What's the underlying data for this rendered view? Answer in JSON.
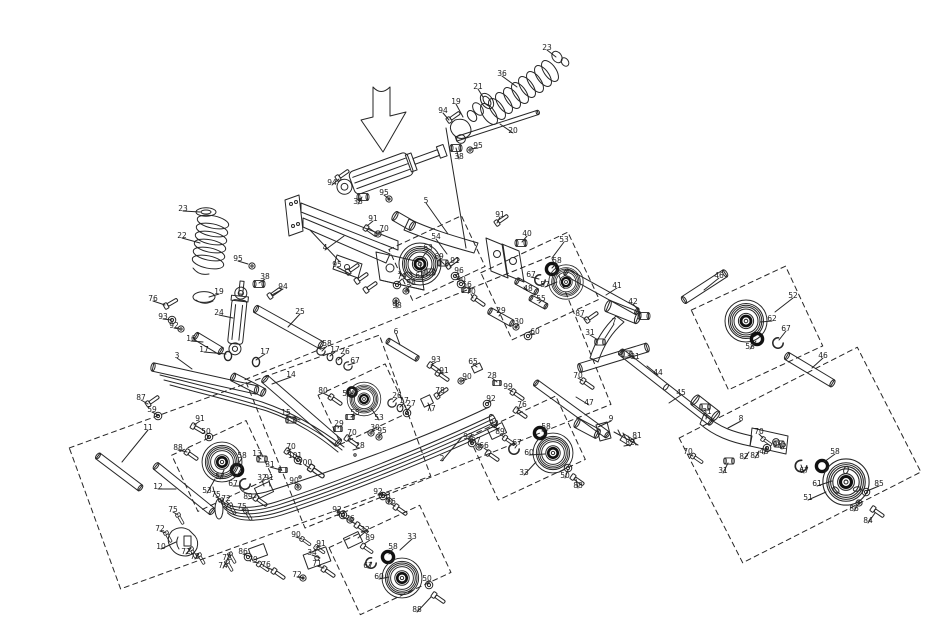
{
  "diagram": {
    "type": "exploded-parts-diagram",
    "subject": "snowmobile rear suspension skid frame",
    "background": "#ffffff",
    "line_color": "#262626",
    "highlight_arrow_color": "#e01c1c",
    "highlight_target": "rear shock absorber"
  },
  "callouts": [
    {
      "n": "23",
      "x": 547,
      "y": 48,
      "t": [
        556,
        57
      ]
    },
    {
      "n": "36",
      "x": 502,
      "y": 74,
      "t": [
        517,
        87
      ]
    },
    {
      "n": "21",
      "x": 478,
      "y": 87,
      "t": [
        483,
        97
      ]
    },
    {
      "n": "19",
      "x": 456,
      "y": 102,
      "t": [
        463,
        117
      ]
    },
    {
      "n": "94",
      "x": 443,
      "y": 111,
      "t": [
        449,
        120
      ]
    },
    {
      "n": "20",
      "x": 513,
      "y": 131,
      "t": [
        500,
        124
      ]
    },
    {
      "n": "95",
      "x": 478,
      "y": 146,
      "t": [
        470,
        149
      ]
    },
    {
      "n": "38",
      "x": 459,
      "y": 157,
      "t": [
        456,
        148
      ]
    },
    {
      "n": "94",
      "x": 332,
      "y": 183,
      "t": [
        339,
        179
      ]
    },
    {
      "n": "95",
      "x": 384,
      "y": 193,
      "t": [
        389,
        199
      ]
    },
    {
      "n": "38",
      "x": 358,
      "y": 202,
      "t": [
        362,
        197
      ]
    },
    {
      "n": "5",
      "x": 426,
      "y": 201,
      "t": [
        448,
        234
      ]
    },
    {
      "n": "91",
      "x": 373,
      "y": 219,
      "t": [
        367,
        226
      ]
    },
    {
      "n": "70",
      "x": 384,
      "y": 229,
      "t": [
        378,
        233
      ]
    },
    {
      "n": "23",
      "x": 183,
      "y": 209,
      "t": [
        200,
        212
      ]
    },
    {
      "n": "22",
      "x": 182,
      "y": 236,
      "t": [
        200,
        243
      ]
    },
    {
      "n": "19",
      "x": 219,
      "y": 292,
      "t": [
        209,
        297
      ]
    },
    {
      "n": "95",
      "x": 238,
      "y": 259,
      "t": [
        248,
        264
      ]
    },
    {
      "n": "38",
      "x": 265,
      "y": 277,
      "t": [
        259,
        283
      ]
    },
    {
      "n": "94",
      "x": 283,
      "y": 287,
      "t": [
        272,
        295
      ]
    },
    {
      "n": "24",
      "x": 219,
      "y": 313,
      "t": [
        233,
        318
      ]
    },
    {
      "n": "25",
      "x": 300,
      "y": 312,
      "t": [
        288,
        327
      ]
    },
    {
      "n": "76",
      "x": 153,
      "y": 299,
      "t": [
        165,
        305
      ]
    },
    {
      "n": "93",
      "x": 163,
      "y": 317,
      "t": [
        172,
        320
      ]
    },
    {
      "n": "92",
      "x": 174,
      "y": 326,
      "t": [
        180,
        329
      ]
    },
    {
      "n": "16",
      "x": 191,
      "y": 339,
      "t": [
        203,
        342
      ]
    },
    {
      "n": "17",
      "x": 204,
      "y": 350,
      "t": [
        226,
        354
      ]
    },
    {
      "n": "17",
      "x": 265,
      "y": 352,
      "t": [
        256,
        360
      ]
    },
    {
      "n": "4",
      "x": 325,
      "y": 248,
      "t": [
        344,
        236
      ]
    },
    {
      "n": "54",
      "x": 436,
      "y": 237,
      "t": [
        447,
        254
      ]
    },
    {
      "n": "63",
      "x": 428,
      "y": 248,
      "t": [
        422,
        258
      ]
    },
    {
      "n": "69",
      "x": 439,
      "y": 257,
      "t": [
        444,
        264
      ]
    },
    {
      "n": "64",
      "x": 420,
      "y": 276,
      "t": [
        430,
        272
      ]
    },
    {
      "n": "79",
      "x": 402,
      "y": 277,
      "t": [
        397,
        284
      ]
    },
    {
      "n": "98",
      "x": 411,
      "y": 283,
      "t": [
        406,
        290
      ]
    },
    {
      "n": "98",
      "x": 397,
      "y": 306,
      "t": [
        396,
        300
      ]
    },
    {
      "n": "95",
      "x": 337,
      "y": 265,
      "t": [
        350,
        274
      ]
    },
    {
      "n": "91",
      "x": 455,
      "y": 261,
      "t": [
        450,
        267
      ]
    },
    {
      "n": "96",
      "x": 459,
      "y": 271,
      "t": [
        455,
        276
      ]
    },
    {
      "n": "90",
      "x": 461,
      "y": 280,
      "t": [
        459,
        284
      ]
    },
    {
      "n": "56",
      "x": 467,
      "y": 285,
      "t": [
        464,
        289
      ]
    },
    {
      "n": "70",
      "x": 471,
      "y": 292,
      "t": [
        473,
        298
      ]
    },
    {
      "n": "91",
      "x": 500,
      "y": 215,
      "t": [
        497,
        223
      ]
    },
    {
      "n": "40",
      "x": 527,
      "y": 234,
      "t": [
        522,
        242
      ]
    },
    {
      "n": "53",
      "x": 564,
      "y": 240,
      "t": [
        552,
        258
      ]
    },
    {
      "n": "58",
      "x": 557,
      "y": 261,
      "t": [
        552,
        268
      ]
    },
    {
      "n": "67",
      "x": 531,
      "y": 275,
      "t": [
        539,
        279
      ]
    },
    {
      "n": "57",
      "x": 545,
      "y": 285,
      "t": [
        557,
        282
      ]
    },
    {
      "n": "48",
      "x": 528,
      "y": 289,
      "t": [
        524,
        287
      ]
    },
    {
      "n": "55",
      "x": 541,
      "y": 299,
      "t": [
        539,
        303
      ]
    },
    {
      "n": "29",
      "x": 501,
      "y": 311,
      "t": [
        499,
        316
      ]
    },
    {
      "n": "30",
      "x": 519,
      "y": 322,
      "t": [
        516,
        327
      ]
    },
    {
      "n": "60",
      "x": 535,
      "y": 332,
      "t": [
        529,
        335
      ]
    },
    {
      "n": "58",
      "x": 327,
      "y": 344,
      "t": [
        322,
        351
      ]
    },
    {
      "n": "17",
      "x": 335,
      "y": 350,
      "t": [
        330,
        356
      ]
    },
    {
      "n": "26",
      "x": 345,
      "y": 352,
      "t": [
        338,
        360
      ]
    },
    {
      "n": "67",
      "x": 355,
      "y": 361,
      "t": [
        348,
        365
      ]
    },
    {
      "n": "6",
      "x": 396,
      "y": 332,
      "t": [
        400,
        345
      ]
    },
    {
      "n": "93",
      "x": 436,
      "y": 360,
      "t": [
        431,
        365
      ]
    },
    {
      "n": "91",
      "x": 444,
      "y": 371,
      "t": [
        439,
        373
      ]
    },
    {
      "n": "65",
      "x": 473,
      "y": 362,
      "t": [
        477,
        367
      ]
    },
    {
      "n": "90",
      "x": 467,
      "y": 377,
      "t": [
        462,
        381
      ]
    },
    {
      "n": "28",
      "x": 492,
      "y": 376,
      "t": [
        497,
        382
      ]
    },
    {
      "n": "99",
      "x": 508,
      "y": 387,
      "t": [
        513,
        392
      ]
    },
    {
      "n": "92",
      "x": 491,
      "y": 399,
      "t": [
        487,
        403
      ]
    },
    {
      "n": "76",
      "x": 522,
      "y": 405,
      "t": [
        517,
        409
      ]
    },
    {
      "n": "77",
      "x": 431,
      "y": 409,
      "t": [
        428,
        403
      ]
    },
    {
      "n": "78",
      "x": 440,
      "y": 391,
      "t": [
        437,
        397
      ]
    },
    {
      "n": "2",
      "x": 442,
      "y": 459,
      "t": [
        462,
        437
      ]
    },
    {
      "n": "3",
      "x": 177,
      "y": 356,
      "t": [
        192,
        369
      ]
    },
    {
      "n": "14",
      "x": 291,
      "y": 375,
      "t": [
        272,
        384
      ]
    },
    {
      "n": "15",
      "x": 286,
      "y": 413,
      "t": [
        300,
        420
      ]
    },
    {
      "n": "80",
      "x": 323,
      "y": 391,
      "t": [
        331,
        397
      ]
    },
    {
      "n": "58",
      "x": 347,
      "y": 394,
      "t": [
        353,
        393
      ]
    },
    {
      "n": "53",
      "x": 379,
      "y": 418,
      "t": [
        371,
        408
      ]
    },
    {
      "n": "55",
      "x": 355,
      "y": 413,
      "t": [
        351,
        417
      ]
    },
    {
      "n": "29",
      "x": 339,
      "y": 424,
      "t": [
        338,
        428
      ]
    },
    {
      "n": "30",
      "x": 375,
      "y": 428,
      "t": [
        371,
        432
      ]
    },
    {
      "n": "95",
      "x": 382,
      "y": 431,
      "t": [
        379,
        436
      ]
    },
    {
      "n": "70",
      "x": 352,
      "y": 433,
      "t": [
        348,
        437
      ]
    },
    {
      "n": "28",
      "x": 360,
      "y": 446,
      "t": [
        353,
        450
      ]
    },
    {
      "n": "26",
      "x": 397,
      "y": 396,
      "t": [
        393,
        402
      ]
    },
    {
      "n": "17",
      "x": 404,
      "y": 401,
      "t": [
        400,
        407
      ]
    },
    {
      "n": "27",
      "x": 411,
      "y": 404,
      "t": [
        406,
        412
      ]
    },
    {
      "n": "70",
      "x": 291,
      "y": 447,
      "t": [
        287,
        451
      ]
    },
    {
      "n": "13",
      "x": 257,
      "y": 454,
      "t": [
        261,
        459
      ]
    },
    {
      "n": "101",
      "x": 295,
      "y": 456,
      "t": [
        298,
        461
      ]
    },
    {
      "n": "31",
      "x": 270,
      "y": 465,
      "t": [
        281,
        470
      ]
    },
    {
      "n": "100",
      "x": 305,
      "y": 463,
      "t": [
        311,
        469
      ]
    },
    {
      "n": "90",
      "x": 294,
      "y": 481,
      "t": [
        299,
        486
      ]
    },
    {
      "n": "87",
      "x": 141,
      "y": 398,
      "t": [
        148,
        404
      ]
    },
    {
      "n": "59",
      "x": 152,
      "y": 410,
      "t": [
        158,
        415
      ]
    },
    {
      "n": "11",
      "x": 148,
      "y": 428,
      "t": [
        122,
        462
      ]
    },
    {
      "n": "91",
      "x": 200,
      "y": 419,
      "t": [
        194,
        425
      ]
    },
    {
      "n": "50",
      "x": 206,
      "y": 432,
      "t": [
        209,
        437
      ]
    },
    {
      "n": "88",
      "x": 178,
      "y": 448,
      "t": [
        187,
        452
      ]
    },
    {
      "n": "12",
      "x": 158,
      "y": 487,
      "t": [
        176,
        489
      ]
    },
    {
      "n": "57",
      "x": 220,
      "y": 477,
      "t": [
        224,
        470
      ]
    },
    {
      "n": "58",
      "x": 242,
      "y": 456,
      "t": [
        238,
        464
      ]
    },
    {
      "n": "53",
      "x": 207,
      "y": 491,
      "t": [
        215,
        479
      ]
    },
    {
      "n": "67",
      "x": 233,
      "y": 484,
      "t": [
        239,
        486
      ]
    },
    {
      "n": "32",
      "x": 262,
      "y": 478,
      "t": [
        264,
        486
      ]
    },
    {
      "n": "91",
      "x": 269,
      "y": 478,
      "t": [
        270,
        486
      ]
    },
    {
      "n": "89",
      "x": 248,
      "y": 497,
      "t": [
        256,
        497
      ]
    },
    {
      "n": "75",
      "x": 216,
      "y": 495,
      "t": [
        221,
        500
      ]
    },
    {
      "n": "72",
      "x": 226,
      "y": 499,
      "t": [
        229,
        504
      ]
    },
    {
      "n": "75",
      "x": 242,
      "y": 507,
      "t": [
        246,
        511
      ]
    },
    {
      "n": "75",
      "x": 173,
      "y": 510,
      "t": [
        178,
        515
      ]
    },
    {
      "n": "72",
      "x": 160,
      "y": 529,
      "t": [
        166,
        533
      ]
    },
    {
      "n": "10",
      "x": 161,
      "y": 547,
      "t": [
        176,
        542
      ]
    },
    {
      "n": "72",
      "x": 186,
      "y": 552,
      "t": [
        191,
        548
      ]
    },
    {
      "n": "73",
      "x": 195,
      "y": 557,
      "t": [
        199,
        553
      ]
    },
    {
      "n": "72",
      "x": 227,
      "y": 558,
      "t": [
        230,
        553
      ]
    },
    {
      "n": "74",
      "x": 223,
      "y": 566,
      "t": [
        227,
        561
      ]
    },
    {
      "n": "86",
      "x": 243,
      "y": 552,
      "t": [
        249,
        556
      ]
    },
    {
      "n": "79",
      "x": 253,
      "y": 560,
      "t": [
        259,
        563
      ]
    },
    {
      "n": "76",
      "x": 266,
      "y": 565,
      "t": [
        273,
        570
      ]
    },
    {
      "n": "34",
      "x": 312,
      "y": 553,
      "t": [
        320,
        558
      ]
    },
    {
      "n": "71",
      "x": 317,
      "y": 564,
      "t": [
        324,
        568
      ]
    },
    {
      "n": "72",
      "x": 297,
      "y": 575,
      "t": [
        303,
        578
      ]
    },
    {
      "n": "90",
      "x": 296,
      "y": 535,
      "t": [
        302,
        539
      ]
    },
    {
      "n": "91",
      "x": 321,
      "y": 544,
      "t": [
        316,
        547
      ]
    },
    {
      "n": "92",
      "x": 337,
      "y": 510,
      "t": [
        343,
        514
      ]
    },
    {
      "n": "93",
      "x": 341,
      "y": 514,
      "t": [
        347,
        519
      ]
    },
    {
      "n": "76",
      "x": 350,
      "y": 519,
      "t": [
        356,
        524
      ]
    },
    {
      "n": "92",
      "x": 378,
      "y": 492,
      "t": [
        383,
        496
      ]
    },
    {
      "n": "93",
      "x": 386,
      "y": 496,
      "t": [
        389,
        500
      ]
    },
    {
      "n": "76",
      "x": 391,
      "y": 502,
      "t": [
        395,
        506
      ]
    },
    {
      "n": "32",
      "x": 365,
      "y": 530,
      "t": [
        358,
        538
      ]
    },
    {
      "n": "89",
      "x": 370,
      "y": 538,
      "t": [
        364,
        544
      ]
    },
    {
      "n": "33",
      "x": 412,
      "y": 537,
      "t": [
        400,
        550
      ]
    },
    {
      "n": "58",
      "x": 393,
      "y": 547,
      "t": [
        389,
        554
      ]
    },
    {
      "n": "67",
      "x": 368,
      "y": 566,
      "t": [
        371,
        562
      ]
    },
    {
      "n": "60",
      "x": 379,
      "y": 577,
      "t": [
        389,
        577
      ]
    },
    {
      "n": "50",
      "x": 427,
      "y": 579,
      "t": [
        429,
        584
      ]
    },
    {
      "n": "88",
      "x": 417,
      "y": 610,
      "t": [
        431,
        597
      ]
    },
    {
      "n": "92",
      "x": 468,
      "y": 437,
      "t": [
        472,
        442
      ]
    },
    {
      "n": "97",
      "x": 476,
      "y": 441,
      "t": [
        479,
        445
      ]
    },
    {
      "n": "66",
      "x": 484,
      "y": 446,
      "t": [
        488,
        451
      ]
    },
    {
      "n": "32",
      "x": 494,
      "y": 424,
      "t": [
        498,
        430
      ]
    },
    {
      "n": "89",
      "x": 500,
      "y": 432,
      "t": [
        504,
        437
      ]
    },
    {
      "n": "67",
      "x": 517,
      "y": 443,
      "t": [
        515,
        448
      ]
    },
    {
      "n": "60",
      "x": 529,
      "y": 453,
      "t": [
        545,
        454
      ]
    },
    {
      "n": "33",
      "x": 524,
      "y": 473,
      "t": [
        536,
        462
      ]
    },
    {
      "n": "58",
      "x": 546,
      "y": 427,
      "t": [
        542,
        431
      ]
    },
    {
      "n": "50",
      "x": 565,
      "y": 476,
      "t": [
        568,
        470
      ]
    },
    {
      "n": "88",
      "x": 578,
      "y": 486,
      "t": [
        576,
        479
      ]
    },
    {
      "n": "41",
      "x": 617,
      "y": 286,
      "t": [
        606,
        295
      ]
    },
    {
      "n": "42",
      "x": 633,
      "y": 302,
      "t": [
        641,
        313
      ]
    },
    {
      "n": "7",
      "x": 614,
      "y": 322,
      "t": [
        605,
        338
      ]
    },
    {
      "n": "31",
      "x": 590,
      "y": 333,
      "t": [
        598,
        340
      ]
    },
    {
      "n": "31",
      "x": 635,
      "y": 357,
      "t": [
        628,
        355
      ]
    },
    {
      "n": "87",
      "x": 580,
      "y": 314,
      "t": [
        587,
        320
      ]
    },
    {
      "n": "70",
      "x": 578,
      "y": 376,
      "t": [
        583,
        381
      ]
    },
    {
      "n": "44",
      "x": 658,
      "y": 373,
      "t": [
        647,
        366
      ]
    },
    {
      "n": "45",
      "x": 681,
      "y": 393,
      "t": [
        669,
        403
      ]
    },
    {
      "n": "47",
      "x": 589,
      "y": 403,
      "t": [
        576,
        397
      ]
    },
    {
      "n": "9",
      "x": 611,
      "y": 419,
      "t": [
        598,
        427
      ]
    },
    {
      "n": "81",
      "x": 637,
      "y": 436,
      "t": [
        631,
        440
      ]
    },
    {
      "n": "82",
      "x": 630,
      "y": 443,
      "t": [
        624,
        446
      ]
    },
    {
      "n": "46",
      "x": 719,
      "y": 276,
      "t": [
        704,
        290
      ]
    },
    {
      "n": "52",
      "x": 793,
      "y": 296,
      "t": [
        775,
        312
      ]
    },
    {
      "n": "62",
      "x": 772,
      "y": 319,
      "t": [
        760,
        322
      ]
    },
    {
      "n": "67",
      "x": 786,
      "y": 329,
      "t": [
        779,
        340
      ]
    },
    {
      "n": "58",
      "x": 750,
      "y": 347,
      "t": [
        756,
        341
      ]
    },
    {
      "n": "46",
      "x": 823,
      "y": 356,
      "t": [
        812,
        368
      ]
    },
    {
      "n": "70",
      "x": 759,
      "y": 432,
      "t": [
        763,
        438
      ]
    },
    {
      "n": "31",
      "x": 707,
      "y": 412,
      "t": [
        706,
        419
      ]
    },
    {
      "n": "8",
      "x": 741,
      "y": 419,
      "t": [
        728,
        428
      ]
    },
    {
      "n": "70",
      "x": 688,
      "y": 452,
      "t": [
        693,
        456
      ]
    },
    {
      "n": "31",
      "x": 723,
      "y": 471,
      "t": [
        728,
        463
      ]
    },
    {
      "n": "42",
      "x": 782,
      "y": 447,
      "t": [
        778,
        442
      ]
    },
    {
      "n": "43",
      "x": 764,
      "y": 452,
      "t": [
        767,
        447
      ]
    },
    {
      "n": "83",
      "x": 755,
      "y": 456,
      "t": [
        759,
        451
      ]
    },
    {
      "n": "82",
      "x": 744,
      "y": 457,
      "t": [
        749,
        452
      ]
    },
    {
      "n": "67",
      "x": 804,
      "y": 471,
      "t": [
        801,
        465
      ]
    },
    {
      "n": "58",
      "x": 835,
      "y": 452,
      "t": [
        824,
        462
      ]
    },
    {
      "n": "61",
      "x": 817,
      "y": 484,
      "t": [
        832,
        481
      ]
    },
    {
      "n": "51",
      "x": 808,
      "y": 498,
      "t": [
        826,
        492
      ]
    },
    {
      "n": "85",
      "x": 879,
      "y": 484,
      "t": [
        867,
        491
      ]
    },
    {
      "n": "86",
      "x": 854,
      "y": 509,
      "t": [
        859,
        503
      ]
    },
    {
      "n": "84",
      "x": 868,
      "y": 521,
      "t": [
        875,
        513
      ]
    }
  ]
}
